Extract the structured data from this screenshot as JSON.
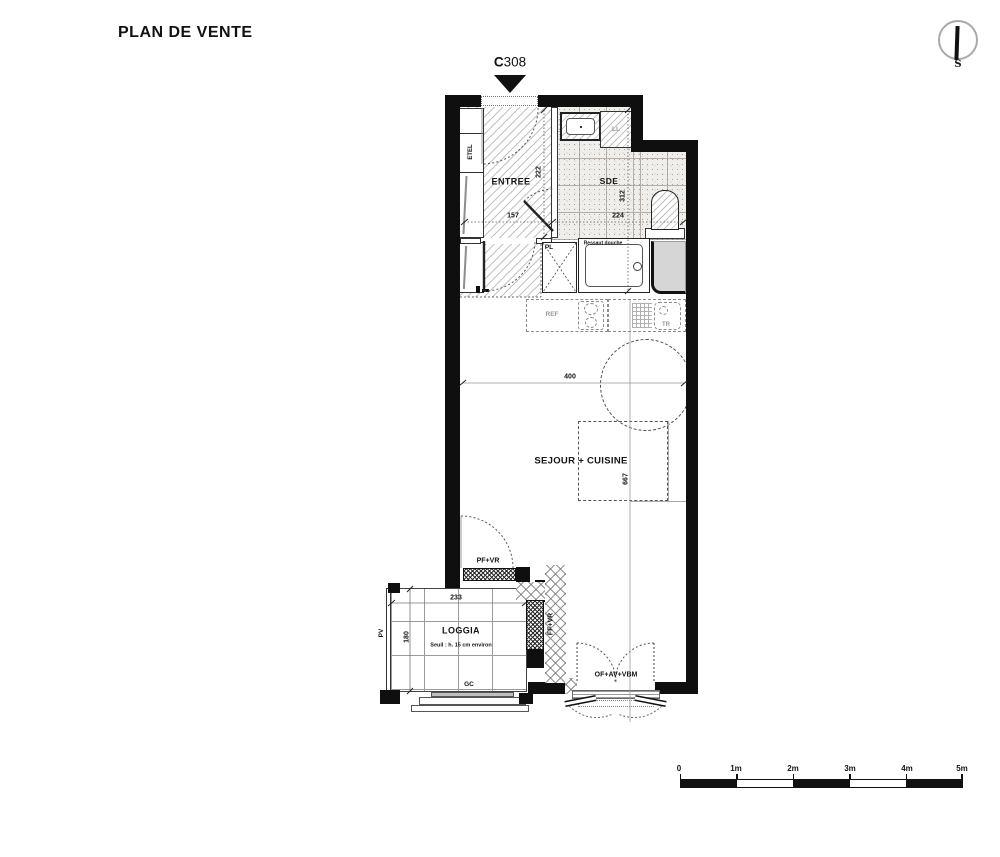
{
  "title": "PLAN DE VENTE",
  "unit": {
    "prefix": "C",
    "number": "308"
  },
  "compass": {
    "south": "S"
  },
  "rooms": {
    "entree": {
      "label": "ENTREE",
      "dim_width": "157",
      "dim_height": "222"
    },
    "sde": {
      "label": "SDE",
      "dim_width": "224",
      "dim_height": "312",
      "shower_note": "Ressaut douche"
    },
    "sejour": {
      "label": "SEJOUR + CUISINE",
      "dim_width": "400",
      "dim_height": "667"
    },
    "loggia": {
      "label": "LOGGIA",
      "dim_width": "233",
      "dim_height": "180",
      "threshold_note": "Seuil : h. 15 cm environ"
    }
  },
  "labels": {
    "etel": "ETEL",
    "ll": "LL",
    "pl": "PL",
    "ref": "REF",
    "tr": "TR",
    "pv": "PV",
    "gc": "GC",
    "pf_vr": "PF+VR",
    "ff_vr": "FF+VR",
    "of_av_vbm": "OF+AV+VBM"
  },
  "scale": {
    "labels": [
      "0",
      "1m",
      "2m",
      "3m",
      "4m",
      "5m"
    ]
  }
}
